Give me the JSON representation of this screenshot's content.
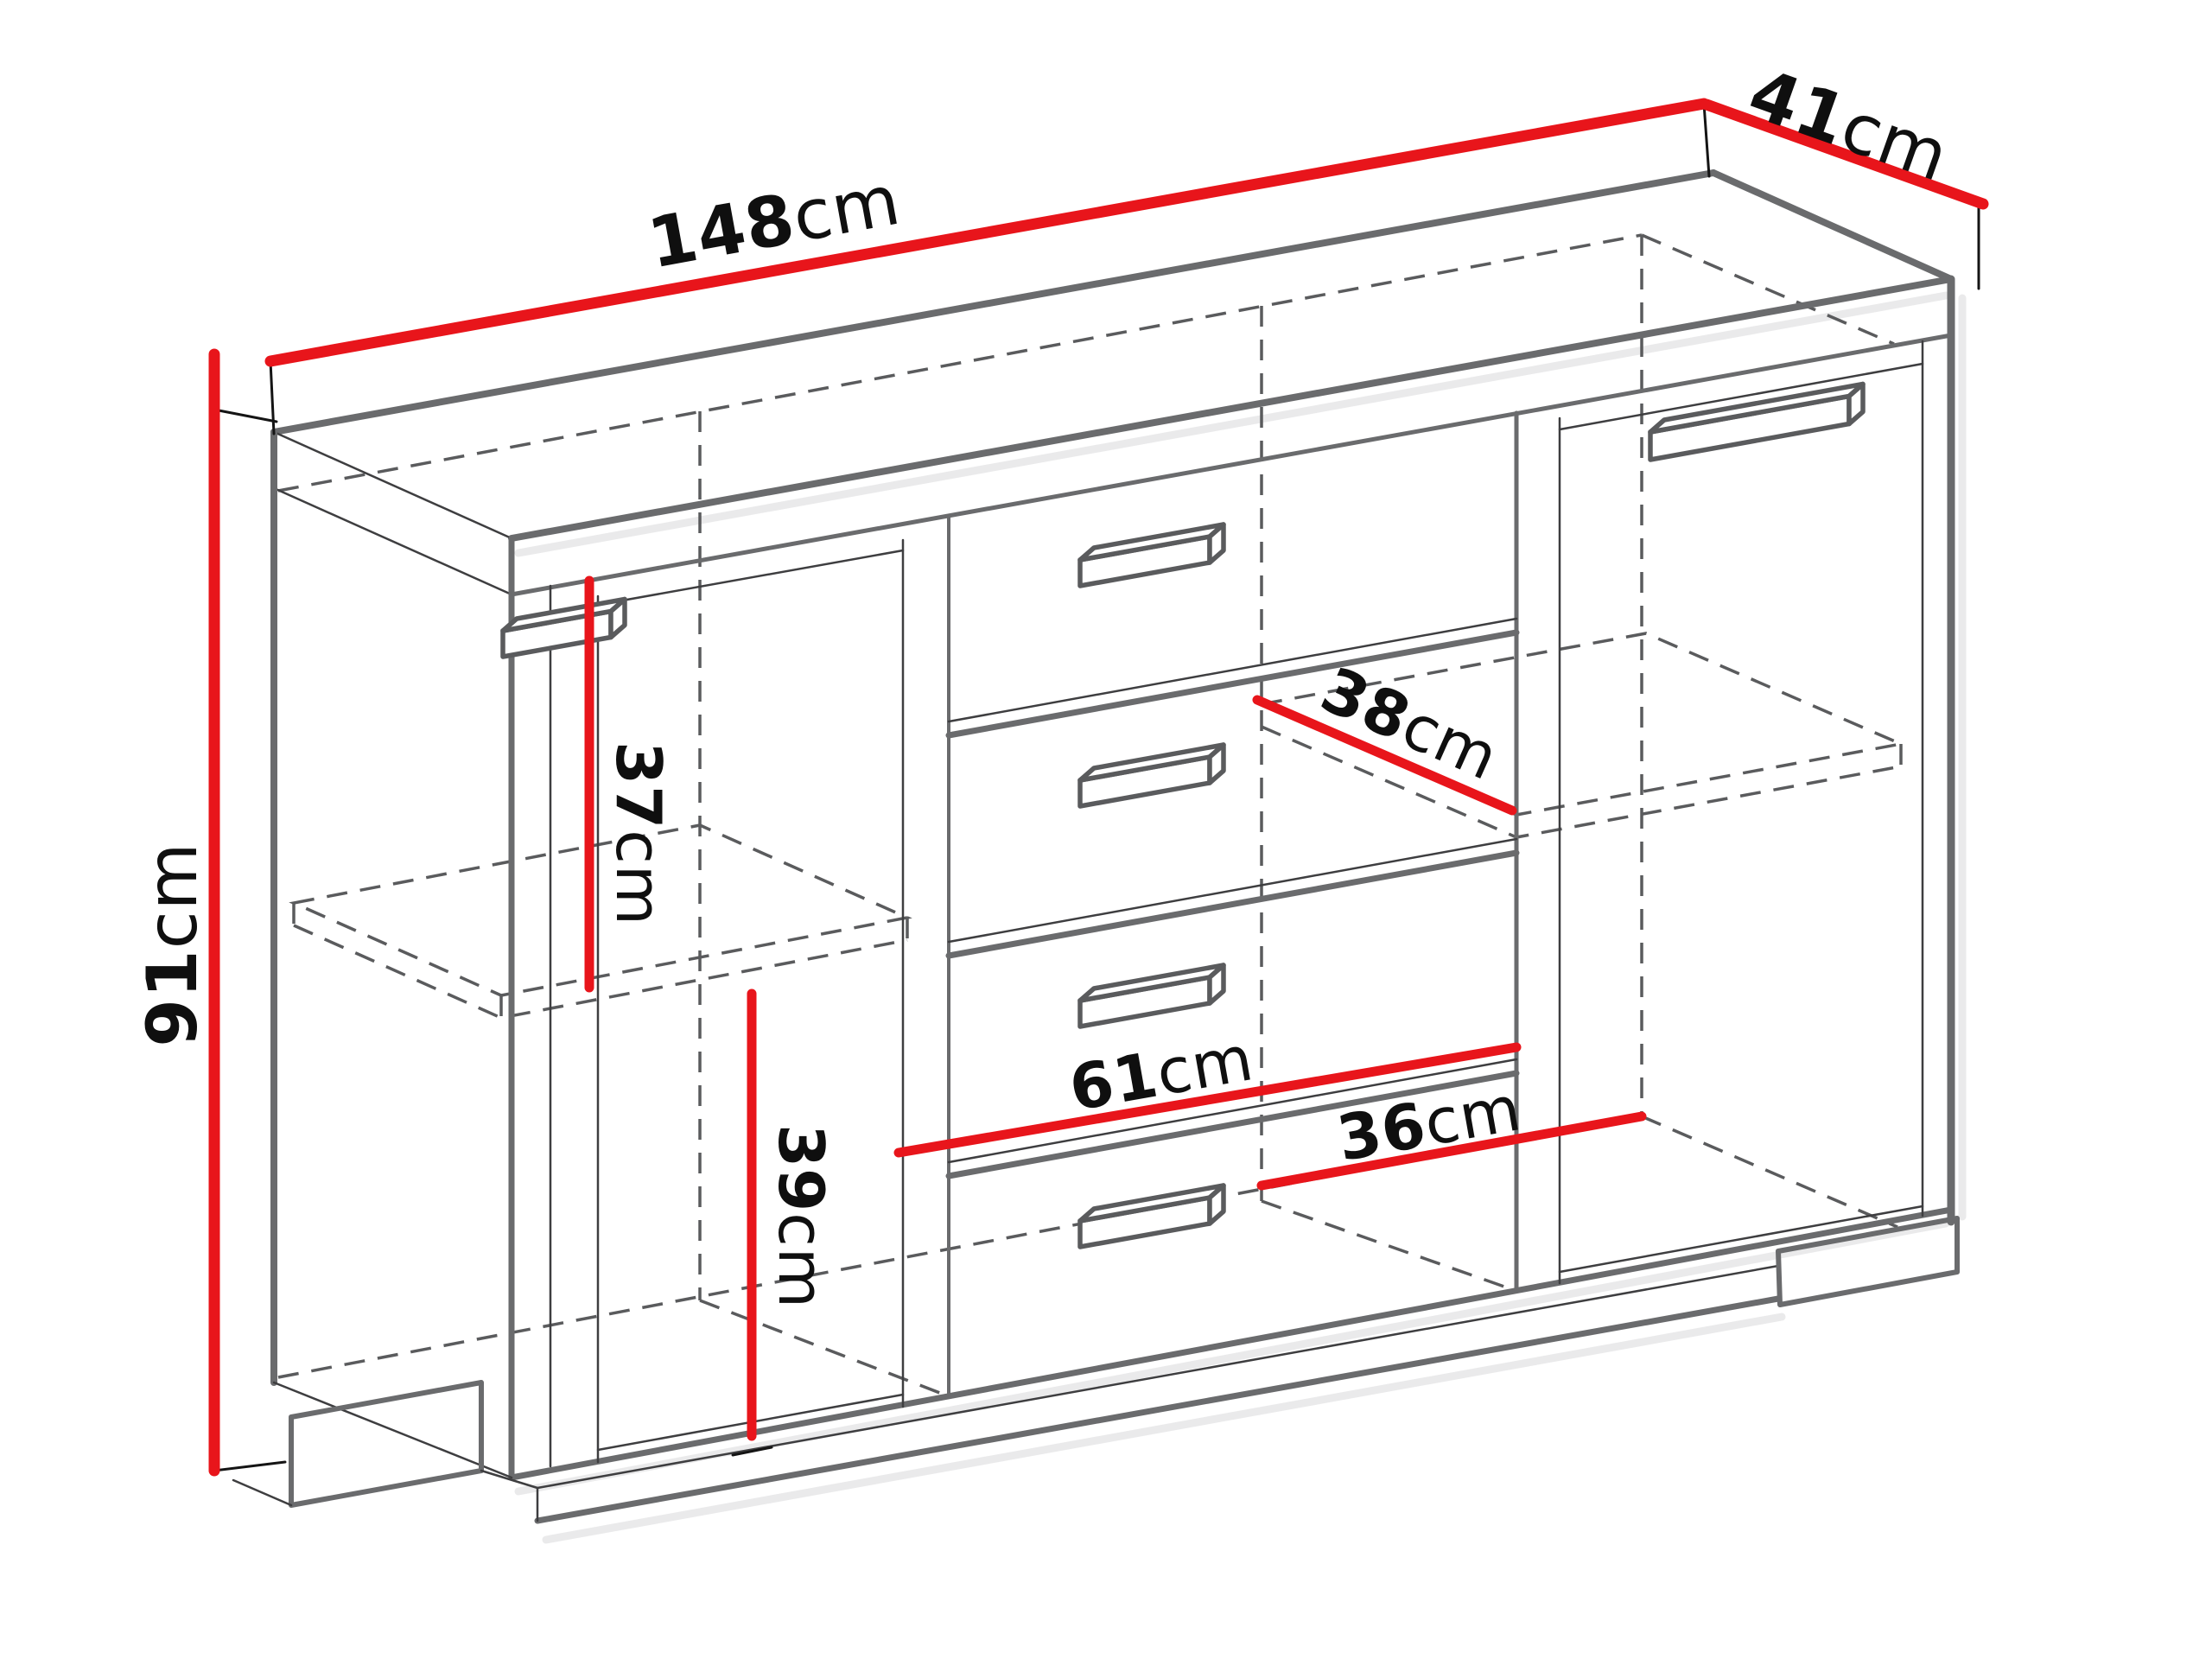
{
  "figure": {
    "kind": "furniture-dimension-diagram",
    "unit": "cm"
  },
  "colors": {
    "dimension_line": "#e8151b",
    "cabinet_outline": "#6a6b6d",
    "hidden_line": "#5a5b5d",
    "label_text": "#0f0f0f",
    "background": "#ffffff"
  },
  "dims": {
    "width": {
      "value": "148",
      "unit": "cm"
    },
    "depth": {
      "value": "41",
      "unit": "cm"
    },
    "height": {
      "value": "91",
      "unit": "cm"
    },
    "left_upper": {
      "value": "37",
      "unit": "cm"
    },
    "left_lower": {
      "value": "39",
      "unit": "cm"
    },
    "shelf_depth": {
      "value": "38",
      "unit": "cm"
    },
    "middle_width": {
      "value": "61",
      "unit": "cm"
    },
    "right_width": {
      "value": "36",
      "unit": "cm"
    }
  }
}
